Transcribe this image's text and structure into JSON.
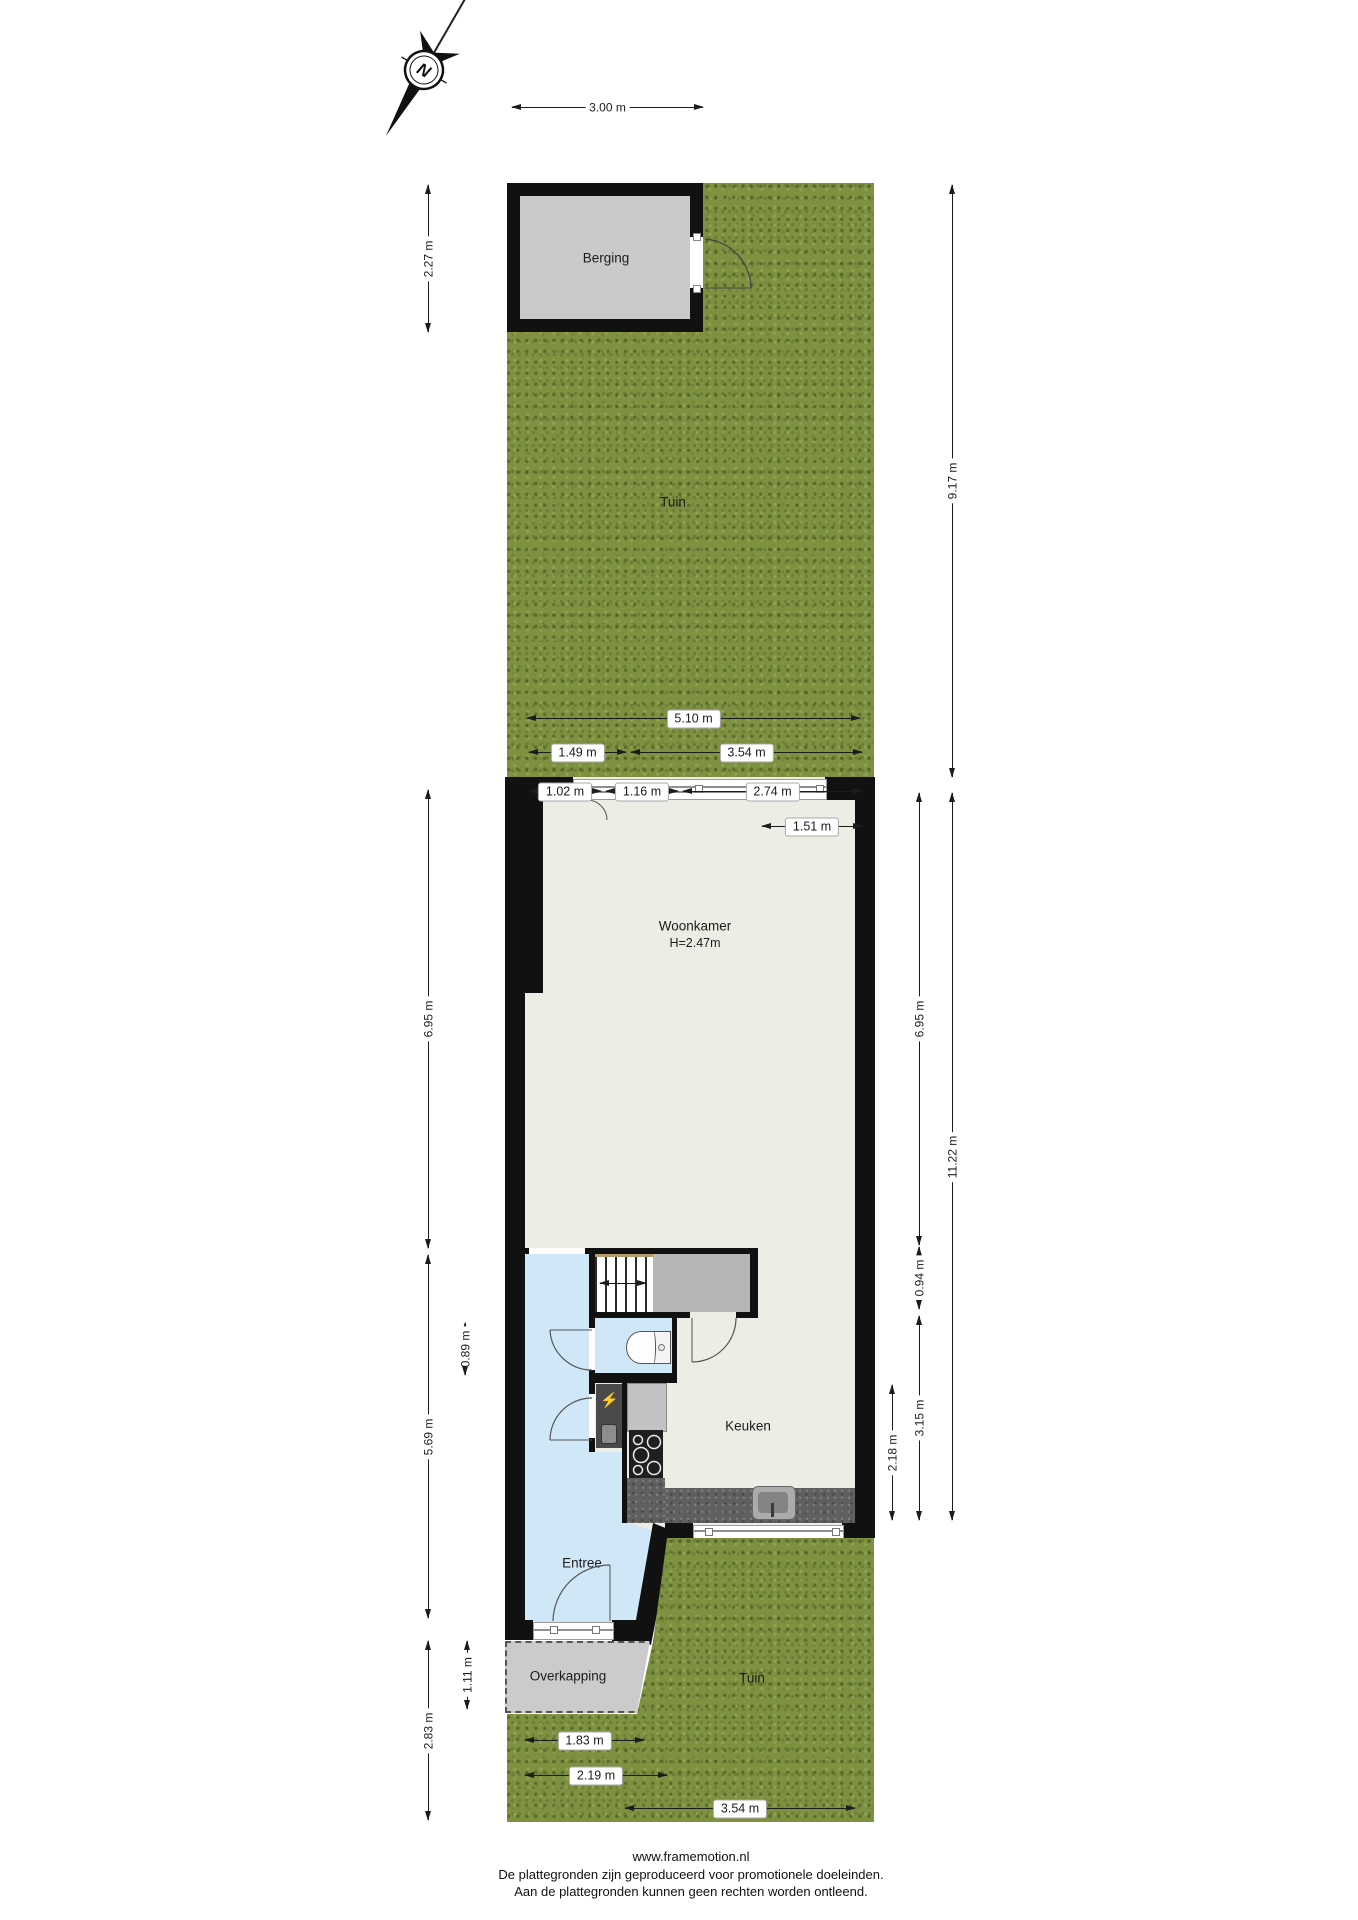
{
  "compass": {
    "letter": "N"
  },
  "rooms": {
    "berging": "Berging",
    "tuin_top": "Tuin",
    "woonkamer": "Woonkamer",
    "woonkamer_height": "H=2.47m",
    "keuken": "Keuken",
    "entree": "Entree",
    "overkapping": "Overkapping",
    "tuin_bottom": "Tuin"
  },
  "dimensions": [
    {
      "id": "top-width",
      "label": "3.00 m",
      "orient": "h",
      "x": 512,
      "y": 107,
      "len": 191,
      "chip": false
    },
    {
      "id": "garden-510",
      "label": "5.10 m",
      "orient": "h",
      "x": 527,
      "y": 718,
      "len": 333,
      "chip": true
    },
    {
      "id": "garden-149",
      "label": "1.49 m",
      "orient": "h",
      "x": 529,
      "y": 752,
      "len": 97,
      "chip": true
    },
    {
      "id": "garden-354",
      "label": "3.54 m",
      "orient": "h",
      "x": 631,
      "y": 752,
      "len": 231,
      "chip": true
    },
    {
      "id": "garden-102",
      "label": "1.02 m",
      "orient": "h",
      "x": 529,
      "y": 791,
      "len": 72,
      "chip": true
    },
    {
      "id": "garden-116",
      "label": "1.16 m",
      "orient": "h",
      "x": 606,
      "y": 791,
      "len": 72,
      "chip": true
    },
    {
      "id": "garden-274",
      "label": "2.74 m",
      "orient": "h",
      "x": 683,
      "y": 791,
      "len": 179,
      "chip": true
    },
    {
      "id": "garden-151",
      "label": "1.51 m",
      "orient": "h",
      "x": 762,
      "y": 826,
      "len": 100,
      "chip": true
    },
    {
      "id": "bottom-183",
      "label": "1.83 m",
      "orient": "h",
      "x": 525,
      "y": 1740,
      "len": 119,
      "chip": true
    },
    {
      "id": "bottom-219",
      "label": "2.19 m",
      "orient": "h",
      "x": 525,
      "y": 1775,
      "len": 142,
      "chip": true
    },
    {
      "id": "bottom-354",
      "label": "3.54 m",
      "orient": "h",
      "x": 625,
      "y": 1808,
      "len": 230,
      "chip": true
    },
    {
      "id": "left-berging",
      "label": "2.27 m",
      "orient": "v",
      "x": 428,
      "y": 185,
      "len": 147,
      "chip": false
    },
    {
      "id": "left-woonkamer",
      "label": "6.95 m",
      "orient": "v",
      "x": 428,
      "y": 790,
      "len": 458,
      "chip": false
    },
    {
      "id": "left-089",
      "label": "0.89 m",
      "orient": "v",
      "x": 465,
      "y": 1323,
      "len": 52,
      "chip": false
    },
    {
      "id": "left-569",
      "label": "5.69 m",
      "orient": "v",
      "x": 428,
      "y": 1255,
      "len": 363,
      "chip": false
    },
    {
      "id": "left-111",
      "label": "1.11 m",
      "orient": "v",
      "x": 467,
      "y": 1641,
      "len": 68,
      "chip": false
    },
    {
      "id": "left-283",
      "label": "2.83 m",
      "orient": "v",
      "x": 428,
      "y": 1641,
      "len": 179,
      "chip": false
    },
    {
      "id": "right-garden",
      "label": "9.17 m",
      "orient": "v",
      "x": 952,
      "y": 185,
      "len": 592,
      "chip": false
    },
    {
      "id": "right-woonkamer",
      "label": "6.95 m",
      "orient": "v",
      "x": 919,
      "y": 793,
      "len": 452,
      "chip": false
    },
    {
      "id": "right-total",
      "label": "11.22 m",
      "orient": "v",
      "x": 952,
      "y": 793,
      "len": 727,
      "chip": false
    },
    {
      "id": "right-094",
      "label": "0.94 m",
      "orient": "v",
      "x": 919,
      "y": 1247,
      "len": 62,
      "chip": false
    },
    {
      "id": "right-315",
      "label": "3.15 m",
      "orient": "v",
      "x": 919,
      "y": 1316,
      "len": 204,
      "chip": false
    },
    {
      "id": "right-218",
      "label": "2.18 m",
      "orient": "v",
      "x": 892,
      "y": 1385,
      "len": 135,
      "chip": false
    }
  ],
  "footer": {
    "site": "www.framemotion.nl",
    "line1": "De plattegronden zijn geproduceerd voor promotionele doeleinden.",
    "line2": "Aan de plattegronden kunnen geen rechten worden ontleend."
  },
  "colors": {
    "grass": "#7d9141",
    "floor": "#ecede4",
    "wall": "#111111",
    "wet_room_blue": "#cfe7f7",
    "closet_gray": "#b6b6b6",
    "berging_gray": "#cacaca",
    "counter_gray": "#5f5f5f",
    "overkapping_gray": "#cbcbcb",
    "stair_trim": "#b59a6e",
    "bolt_yellow": "#f5d413"
  }
}
